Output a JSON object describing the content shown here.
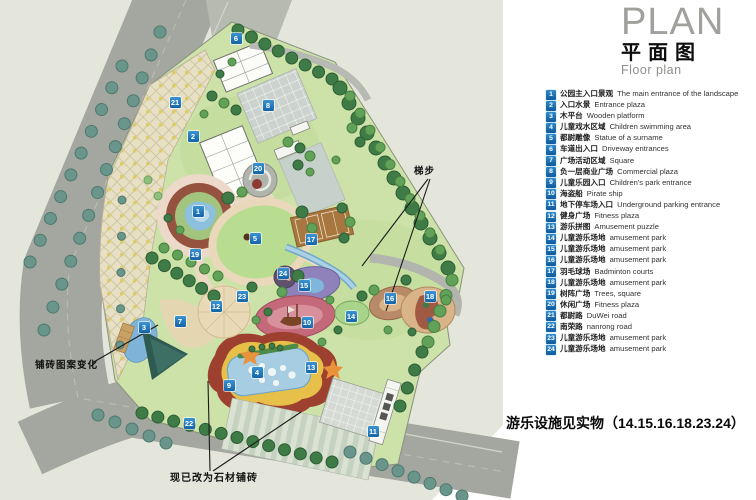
{
  "title": {
    "plan": "PLAN",
    "zh": "平面图",
    "floor": "Floor plan"
  },
  "note": {
    "text": "游乐设施见实物（14.15.16.18.23.24）"
  },
  "map_labels": {
    "steps": "梯步",
    "paving_change": "铺砖图案变化",
    "stone_paving": "现已改为石材铺砖"
  },
  "colors": {
    "marker_blue": "#1a78c2",
    "ground": "#e5e6db",
    "road": "#a4a79f",
    "park_green": "#cde2a9",
    "water_blue": "#8cc0dc",
    "pool_yellow": "#e6c049",
    "pool_red": "#9d4030",
    "track_red": "#93503e"
  },
  "markers": [
    {
      "n": "1",
      "x": 198,
      "y": 211
    },
    {
      "n": "2",
      "x": 193,
      "y": 136
    },
    {
      "n": "3",
      "x": 144,
      "y": 327
    },
    {
      "n": "4",
      "x": 257,
      "y": 372
    },
    {
      "n": "5",
      "x": 255,
      "y": 238
    },
    {
      "n": "6",
      "x": 236,
      "y": 38
    },
    {
      "n": "7",
      "x": 180,
      "y": 321
    },
    {
      "n": "8",
      "x": 268,
      "y": 105
    },
    {
      "n": "9",
      "x": 229,
      "y": 385
    },
    {
      "n": "10",
      "x": 307,
      "y": 322
    },
    {
      "n": "11",
      "x": 373,
      "y": 431
    },
    {
      "n": "12",
      "x": 216,
      "y": 306
    },
    {
      "n": "13",
      "x": 311,
      "y": 367
    },
    {
      "n": "14",
      "x": 351,
      "y": 316
    },
    {
      "n": "15",
      "x": 304,
      "y": 285
    },
    {
      "n": "16",
      "x": 390,
      "y": 298
    },
    {
      "n": "17",
      "x": 311,
      "y": 239
    },
    {
      "n": "18",
      "x": 430,
      "y": 296
    },
    {
      "n": "19",
      "x": 195,
      "y": 254
    },
    {
      "n": "20",
      "x": 258,
      "y": 168
    },
    {
      "n": "21",
      "x": 175,
      "y": 102
    },
    {
      "n": "22",
      "x": 189,
      "y": 423
    },
    {
      "n": "23",
      "x": 242,
      "y": 296
    },
    {
      "n": "24",
      "x": 283,
      "y": 273
    }
  ],
  "legend": [
    {
      "n": "1",
      "zh": "公园主入口景观",
      "en": "The main entrance of the landscape"
    },
    {
      "n": "2",
      "zh": "入口水景",
      "en": "Entrance plaza"
    },
    {
      "n": "3",
      "zh": "木平台",
      "en": "Wooden platform"
    },
    {
      "n": "4",
      "zh": "儿童戏水区域",
      "en": "Children swimming area"
    },
    {
      "n": "5",
      "zh": "都尉雕像",
      "en": "Statue of a surname"
    },
    {
      "n": "6",
      "zh": "车道出入口",
      "en": "Driveway entrances"
    },
    {
      "n": "7",
      "zh": "广场活动区域",
      "en": "Square"
    },
    {
      "n": "8",
      "zh": "负一层商业广场",
      "en": "Commercial plaza"
    },
    {
      "n": "9",
      "zh": "儿童乐园入口",
      "en": "Children's park entrance"
    },
    {
      "n": "10",
      "zh": "海盗船",
      "en": "Pirate ship"
    },
    {
      "n": "11",
      "zh": "地下停车场入口",
      "en": "Underground parking entrance"
    },
    {
      "n": "12",
      "zh": "健身广场",
      "en": "Fitness plaza"
    },
    {
      "n": "13",
      "zh": "游乐拼图",
      "en": "Amusement puzzle"
    },
    {
      "n": "14",
      "zh": "儿童游乐场地",
      "en": "amusement park"
    },
    {
      "n": "15",
      "zh": "儿童游乐场地",
      "en": "amusement park"
    },
    {
      "n": "16",
      "zh": "儿童游乐场地",
      "en": "amusement park"
    },
    {
      "n": "17",
      "zh": "羽毛球场",
      "en": "Badminton courts"
    },
    {
      "n": "18",
      "zh": "儿童游乐场地",
      "en": "amusement park"
    },
    {
      "n": "19",
      "zh": "树阵广场",
      "en": "Trees, square"
    },
    {
      "n": "20",
      "zh": "休闲广场",
      "en": "Fitness plaza"
    },
    {
      "n": "21",
      "zh": "都尉路",
      "en": "DuWei road"
    },
    {
      "n": "22",
      "zh": "南荣路",
      "en": "nanrong road"
    },
    {
      "n": "23",
      "zh": "儿童游乐场地",
      "en": "amusement park"
    },
    {
      "n": "24",
      "zh": "儿童游乐场地",
      "en": "amusement park"
    }
  ]
}
